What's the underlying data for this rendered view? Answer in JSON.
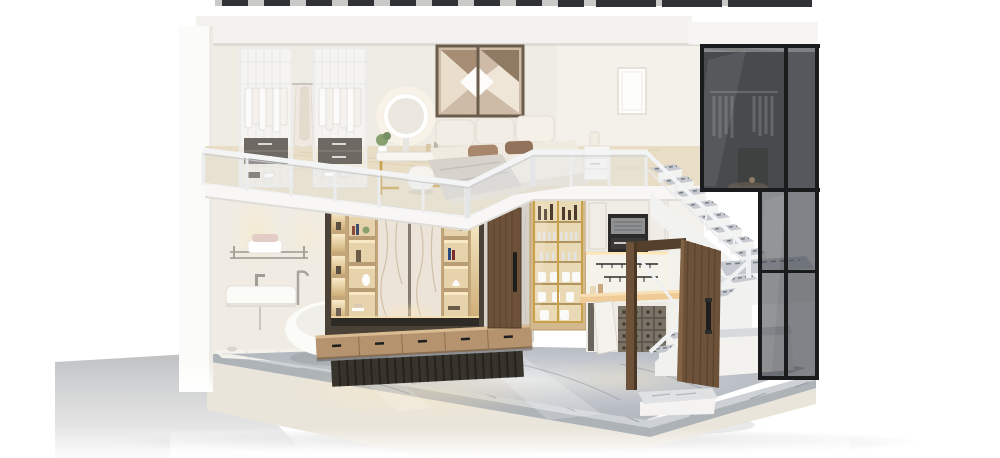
{
  "scene": {
    "title": "loft-apartment-cutaway-render",
    "type": "3d-interior-dollhouse-section",
    "description": "Photorealistic cutaway render of a two-story loft: mezzanine bedroom and dressing area above; bathroom, shelving media wall, kitchen, switchback staircase, open walnut entry door and tinted glass closet wall below, on a grey marble plinth."
  },
  "palette": {
    "background": "#ffffff",
    "ceiling": "#f3f2ef",
    "ceiling_shade": "#dedcd6",
    "roof_glass": "#313236",
    "exterior_wall": "#fbfbf9",
    "wall_upper": "#efece4",
    "wall_upper_right": "#f4f1ea",
    "wall_lower": "#f0ece3",
    "wall_stair": "#f3f1ec",
    "wall_gray": "#d6d2ca",
    "wood_floor": "#e9ddc5",
    "slab": "#f8f7f5",
    "railing": "#f3f4f6",
    "railing_shadow": "#c9cbcd",
    "railing_glass": "rgba(226,233,239,0.32)",
    "tile": "#f4f2ec",
    "tile_line": "#ddd9d0",
    "marble_floor": "#b7bcc2",
    "marble_band_top": "#ced2d6",
    "marble_band_face": "#aeb3b8",
    "marble_vein": "#878c91",
    "plinth": "#eae5da",
    "shadow": "#b7b9ba",
    "bronze": "#4a4237",
    "shelf_wood": "#c3a67a",
    "niche": "#e6d3ab",
    "niche_glow": "#f8e9c4",
    "marble_panel": "#ece4d8",
    "panel_vein": "#c9b79c",
    "console": "#b5936f",
    "console_top": "#d9bb92",
    "fluted": "#38342c",
    "warm_glow": "#f6e0ac",
    "walnut": "#6d5138",
    "walnut_dark": "#54402c",
    "handle_black": "#1d1d1d",
    "cabinet_wood": "#d2b88c",
    "cabinet_inner": "#e9d9b4",
    "gold": "#c9a148",
    "kitchen_white": "#f0ede6",
    "appliance": "#2c2a28",
    "steel": "#8f9092",
    "counter": "#eecb97",
    "wine_rack": "#7b7466",
    "stair_white": "#f2f2f0",
    "tread": "#c6cad0",
    "tread_dark": "#666b72",
    "glass_tint": "rgba(44,47,52,0.55)",
    "glass_tint_light": "rgba(110,114,120,0.35)",
    "glass_frame": "#1a1b1d",
    "closet_interior": "#6e6c6d",
    "white_fixture": "#fbfbf8",
    "bed_base": "#f0ebe1",
    "cushion": "#f2eee6",
    "pillow_brown": "#a8876d",
    "pillow_dark": "#93725b",
    "blanket": "#d7d3cc",
    "mirror_frame": "#6b5c4c",
    "mirror_face": "#cdbba8",
    "frame_white": "#fdfdfb",
    "chrome": "#b0ada5",
    "plant_green": "#87a06e",
    "doorstep": "#f4f3f1",
    "wardrobe_frame": "#ececea",
    "drawer_gray": "#6e6963"
  },
  "levels": {
    "upper": {
      "label": "mezzanine bedroom and dressing area",
      "objects": [
        {
          "id": "glass-wardrobe-a",
          "label": "glass wardrobe with white clothing"
        },
        {
          "id": "glass-wardrobe-b",
          "label": "glass wardrobe with white clothing"
        },
        {
          "id": "hanging-robes",
          "label": "robes on open rail"
        },
        {
          "id": "vanity-table",
          "label": "gold-leg vanity with round LED mirror"
        },
        {
          "id": "vanity-stool",
          "label": "white pouf stool"
        },
        {
          "id": "shoe-display",
          "label": "low glass shoe showcase"
        },
        {
          "id": "geometric-wall-mirror",
          "label": "faceted wall mirror art"
        },
        {
          "id": "bed",
          "label": "low platform bed with cushions and throw"
        },
        {
          "id": "nightstand",
          "label": "white nightstand with lamp"
        },
        {
          "id": "wall-frame",
          "label": "blank white picture frame"
        },
        {
          "id": "glass-railing",
          "label": "white framed mezzanine railing"
        }
      ]
    },
    "lower": {
      "label": "bathroom, living wall, kitchen and entry",
      "objects": [
        {
          "id": "towel-rail",
          "label": "chrome towel rail with towels"
        },
        {
          "id": "wall-sink",
          "label": "wall hung basin"
        },
        {
          "id": "freestanding-bathtub",
          "label": "white oval bathtub"
        },
        {
          "id": "feature-wall",
          "label": "bronze framed marble and wood shelving wall"
        },
        {
          "id": "media-console",
          "label": "floating wood drawer console"
        },
        {
          "id": "interior-door",
          "label": "closed walnut door"
        },
        {
          "id": "display-cabinet",
          "label": "gold glass display cabinet"
        },
        {
          "id": "kitchen",
          "label": "kitchenette with oven, counter and wine rack"
        },
        {
          "id": "entry-door",
          "label": "open walnut entry door"
        },
        {
          "id": "door-step",
          "label": "white entry step"
        },
        {
          "id": "staircase",
          "label": "switchback stair with marble treads"
        },
        {
          "id": "glass-facade",
          "label": "black framed tinted glass closet wall"
        }
      ]
    }
  }
}
